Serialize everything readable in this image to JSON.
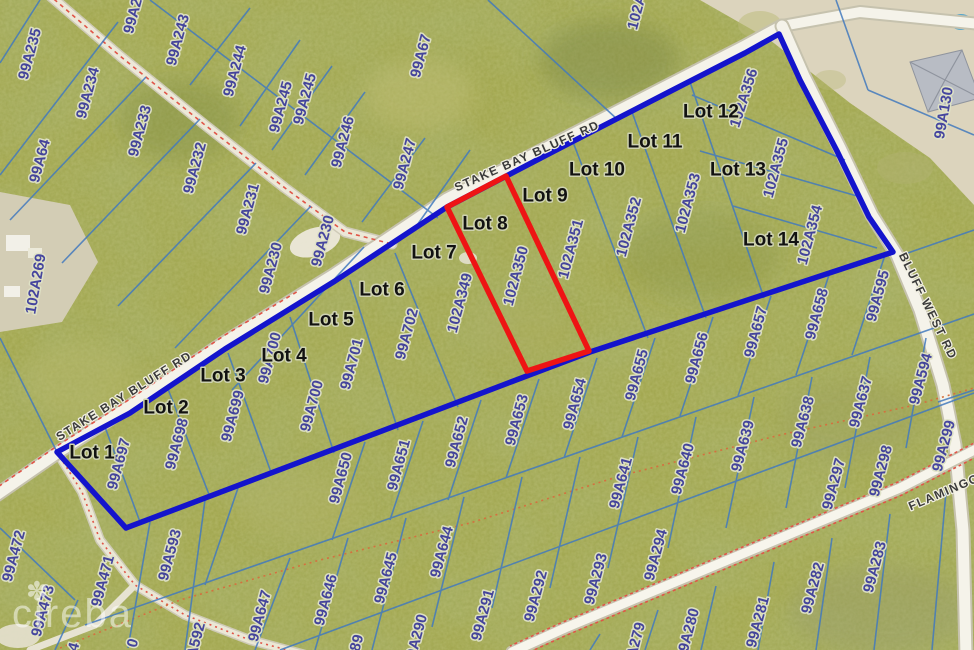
{
  "map": {
    "title": "Stake Bay Bluff Rd subdivision parcel map",
    "watermark": {
      "text": "cireba",
      "flower_icon": "✽"
    },
    "highlights": {
      "subject_lot": "Lot 8",
      "subject_parcel": "102A350",
      "subdivision_boundary_color": "#1414cc",
      "subject_parcel_color": "#ee1414"
    },
    "colors": {
      "vegetation": "#a3a851",
      "parcel_line": "#4279bd",
      "road_fill": "#f4f2e8",
      "trail_dash": "#e05548",
      "parcel_text": "#40409e",
      "lot_text": "#121212",
      "sand": "#dcd4bd"
    },
    "road_labels": [
      {
        "text": "STAKE BAY BLUFF RD",
        "x": 527,
        "y": 156,
        "rot": -24
      },
      {
        "text": "STAKE BAY BLUFF RD",
        "x": 124,
        "y": 396,
        "rot": -32
      },
      {
        "text": "BLUFF WEST RD",
        "x": 928,
        "y": 306,
        "rot": 64
      },
      {
        "text": "FLAMINGO",
        "x": 944,
        "y": 492,
        "rot": -23
      }
    ],
    "lot_labels": [
      {
        "text": "Lot 1",
        "x": 92,
        "y": 453
      },
      {
        "text": "Lot 2",
        "x": 166,
        "y": 408
      },
      {
        "text": "Lot 3",
        "x": 223,
        "y": 376
      },
      {
        "text": "Lot 4",
        "x": 284,
        "y": 356
      },
      {
        "text": "Lot 5",
        "x": 331,
        "y": 320
      },
      {
        "text": "Lot 6",
        "x": 382,
        "y": 290
      },
      {
        "text": "Lot 7",
        "x": 434,
        "y": 253
      },
      {
        "text": "Lot 8",
        "x": 485,
        "y": 224
      },
      {
        "text": "Lot 9",
        "x": 545,
        "y": 196
      },
      {
        "text": "Lot 10",
        "x": 597,
        "y": 170
      },
      {
        "text": "Lot 11",
        "x": 655,
        "y": 142
      },
      {
        "text": "Lot 12",
        "x": 711,
        "y": 112
      },
      {
        "text": "Lot 13",
        "x": 738,
        "y": 170
      },
      {
        "text": "Lot 14",
        "x": 771,
        "y": 240
      }
    ],
    "parcel_labels": [
      {
        "text": "99A235",
        "x": 30,
        "y": 54
      },
      {
        "text": "99A2",
        "x": 133,
        "y": 16
      },
      {
        "text": "99A243",
        "x": 178,
        "y": 40
      },
      {
        "text": "99A244",
        "x": 235,
        "y": 71
      },
      {
        "text": "99A245",
        "x": 281,
        "y": 107
      },
      {
        "text": "99A245",
        "x": 305,
        "y": 99
      },
      {
        "text": "99A234",
        "x": 88,
        "y": 93
      },
      {
        "text": "99A233",
        "x": 140,
        "y": 131
      },
      {
        "text": "99A232",
        "x": 195,
        "y": 168
      },
      {
        "text": "99A231",
        "x": 248,
        "y": 209
      },
      {
        "text": "99A230",
        "x": 271,
        "y": 268
      },
      {
        "text": "99A230",
        "x": 323,
        "y": 241
      },
      {
        "text": "99A64",
        "x": 40,
        "y": 161
      },
      {
        "text": "102A269",
        "x": 36,
        "y": 284,
        "rot": -80
      },
      {
        "text": "99A246",
        "x": 343,
        "y": 142
      },
      {
        "text": "99A247",
        "x": 405,
        "y": 164
      },
      {
        "text": "99A67",
        "x": 421,
        "y": 56
      },
      {
        "text": "102A",
        "x": 637,
        "y": 12
      },
      {
        "text": "102A356",
        "x": 744,
        "y": 98,
        "rot": -72
      },
      {
        "text": "102A355",
        "x": 776,
        "y": 168
      },
      {
        "text": "102A353",
        "x": 688,
        "y": 203
      },
      {
        "text": "102A352",
        "x": 629,
        "y": 227
      },
      {
        "text": "102A354",
        "x": 810,
        "y": 235
      },
      {
        "text": "102A351",
        "x": 571,
        "y": 249
      },
      {
        "text": "102A350",
        "x": 516,
        "y": 276
      },
      {
        "text": "102A349",
        "x": 460,
        "y": 303
      },
      {
        "text": "99A702",
        "x": 407,
        "y": 334
      },
      {
        "text": "99A701",
        "x": 352,
        "y": 364
      },
      {
        "text": "99A700",
        "x": 270,
        "y": 358
      },
      {
        "text": "99A700",
        "x": 312,
        "y": 406
      },
      {
        "text": "99A699",
        "x": 233,
        "y": 416
      },
      {
        "text": "99A698",
        "x": 177,
        "y": 444
      },
      {
        "text": "99A697",
        "x": 119,
        "y": 464
      },
      {
        "text": "99A130",
        "x": 944,
        "y": 113,
        "rot": -80
      },
      {
        "text": "99A595",
        "x": 878,
        "y": 296
      },
      {
        "text": "99A594",
        "x": 921,
        "y": 379
      },
      {
        "text": "99A299",
        "x": 944,
        "y": 446
      },
      {
        "text": "99A298",
        "x": 881,
        "y": 471
      },
      {
        "text": "99A297",
        "x": 834,
        "y": 484
      },
      {
        "text": "99A658",
        "x": 817,
        "y": 314
      },
      {
        "text": "99A657",
        "x": 756,
        "y": 332
      },
      {
        "text": "99A656",
        "x": 697,
        "y": 358
      },
      {
        "text": "99A655",
        "x": 637,
        "y": 375
      },
      {
        "text": "99A654",
        "x": 575,
        "y": 404
      },
      {
        "text": "99A653",
        "x": 517,
        "y": 420
      },
      {
        "text": "99A652",
        "x": 457,
        "y": 442
      },
      {
        "text": "99A651",
        "x": 399,
        "y": 465
      },
      {
        "text": "99A650",
        "x": 341,
        "y": 478
      },
      {
        "text": "99A641",
        "x": 621,
        "y": 483
      },
      {
        "text": "99A640",
        "x": 683,
        "y": 469
      },
      {
        "text": "99A639",
        "x": 743,
        "y": 446
      },
      {
        "text": "99A638",
        "x": 803,
        "y": 422
      },
      {
        "text": "99A637",
        "x": 861,
        "y": 402
      },
      {
        "text": "99A644",
        "x": 442,
        "y": 552
      },
      {
        "text": "99A645",
        "x": 386,
        "y": 578
      },
      {
        "text": "99A646",
        "x": 326,
        "y": 600
      },
      {
        "text": "99A647",
        "x": 260,
        "y": 616
      },
      {
        "text": "99A593",
        "x": 170,
        "y": 555
      },
      {
        "text": "99A592",
        "x": 194,
        "y": 648
      },
      {
        "text": "99A290",
        "x": 416,
        "y": 640
      },
      {
        "text": "89",
        "x": 357,
        "y": 643
      },
      {
        "text": "0",
        "x": 133,
        "y": 643
      },
      {
        "text": "4",
        "x": 74,
        "y": 647
      },
      {
        "text": "99A291",
        "x": 483,
        "y": 615
      },
      {
        "text": "99A292",
        "x": 536,
        "y": 596
      },
      {
        "text": "99A293",
        "x": 596,
        "y": 579
      },
      {
        "text": "99A294",
        "x": 656,
        "y": 555
      },
      {
        "text": "99A283",
        "x": 875,
        "y": 567
      },
      {
        "text": "99A282",
        "x": 813,
        "y": 588
      },
      {
        "text": "99A281",
        "x": 758,
        "y": 622
      },
      {
        "text": "99A280",
        "x": 688,
        "y": 634
      },
      {
        "text": "99A279",
        "x": 634,
        "y": 648
      },
      {
        "text": "99A472",
        "x": 14,
        "y": 556
      },
      {
        "text": "99A473",
        "x": 43,
        "y": 611
      },
      {
        "text": "99A471",
        "x": 103,
        "y": 581
      }
    ]
  }
}
